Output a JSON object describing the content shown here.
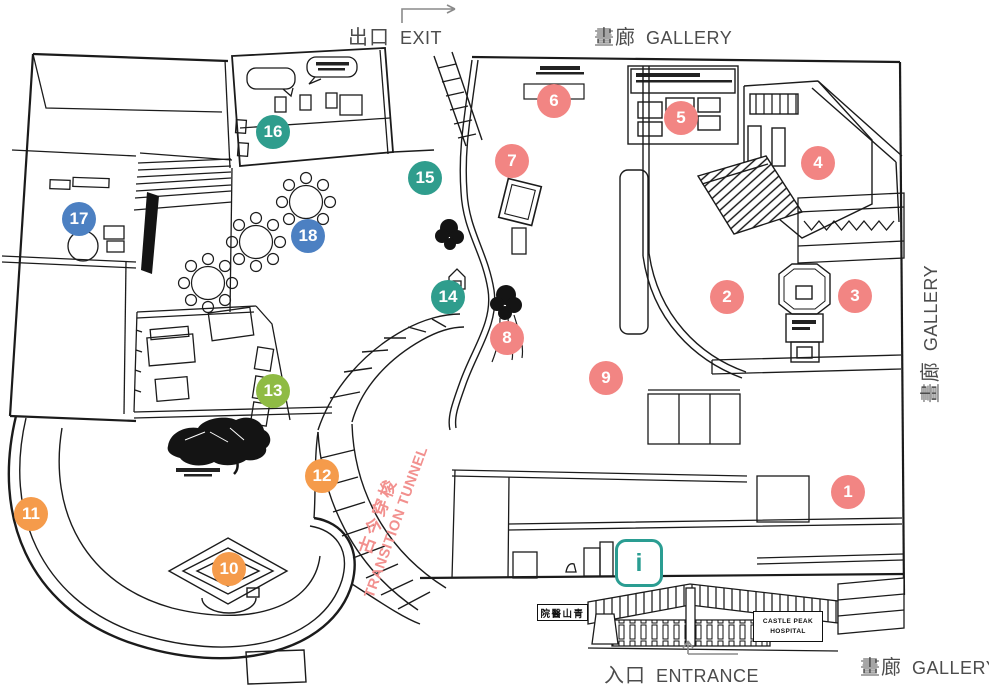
{
  "canvas": {
    "width": 989,
    "height": 696,
    "background": "#ffffff",
    "line_color": "#1b1b1b"
  },
  "labels": {
    "exit": {
      "zh": "出口",
      "en": "EXIT"
    },
    "gallery_top": {
      "zh": "畫廊",
      "en": "GALLERY"
    },
    "gallery_right": {
      "zh": "畫廊",
      "en": "GALLERY"
    },
    "gallery_bottom": {
      "zh": "畫廊",
      "en": "GALLERY"
    },
    "entrance": {
      "zh": "入口",
      "en": "ENTRANCE"
    },
    "tunnel": {
      "zh": "古今穿梭",
      "en": "TRANSITION TUNNEL"
    }
  },
  "signs": {
    "hospital_line1": "CASTLE PEAK",
    "hospital_line2": "HOSPITAL",
    "hospital_zh": "院醫山青",
    "info_glyph": "i"
  },
  "colors": {
    "label_text": "#4c4c4c",
    "tunnel_text": "#f2908e",
    "info_icon": "#2a9d92",
    "marker_groups": {
      "salmon": "#f28583",
      "orange": "#f59b4b",
      "green": "#8fbb44",
      "teal": "#2f9d8d",
      "blue": "#4c80c2"
    }
  },
  "markers": {
    "items": [
      {
        "n": "1",
        "x": 848,
        "y": 492,
        "group": "salmon"
      },
      {
        "n": "2",
        "x": 727,
        "y": 297,
        "group": "salmon"
      },
      {
        "n": "3",
        "x": 855,
        "y": 296,
        "group": "salmon"
      },
      {
        "n": "4",
        "x": 818,
        "y": 163,
        "group": "salmon"
      },
      {
        "n": "5",
        "x": 681,
        "y": 118,
        "group": "salmon"
      },
      {
        "n": "6",
        "x": 554,
        "y": 101,
        "group": "salmon"
      },
      {
        "n": "7",
        "x": 512,
        "y": 161,
        "group": "salmon"
      },
      {
        "n": "8",
        "x": 507,
        "y": 338,
        "group": "salmon"
      },
      {
        "n": "9",
        "x": 606,
        "y": 378,
        "group": "salmon"
      },
      {
        "n": "10",
        "x": 229,
        "y": 569,
        "group": "orange"
      },
      {
        "n": "11",
        "x": 31,
        "y": 514,
        "group": "orange"
      },
      {
        "n": "12",
        "x": 322,
        "y": 476,
        "group": "orange"
      },
      {
        "n": "13",
        "x": 273,
        "y": 391,
        "group": "green"
      },
      {
        "n": "14",
        "x": 448,
        "y": 297,
        "group": "teal"
      },
      {
        "n": "15",
        "x": 425,
        "y": 178,
        "group": "teal"
      },
      {
        "n": "16",
        "x": 273,
        "y": 132,
        "group": "teal"
      },
      {
        "n": "17",
        "x": 79,
        "y": 219,
        "group": "blue"
      },
      {
        "n": "18",
        "x": 308,
        "y": 236,
        "group": "blue"
      }
    ]
  }
}
